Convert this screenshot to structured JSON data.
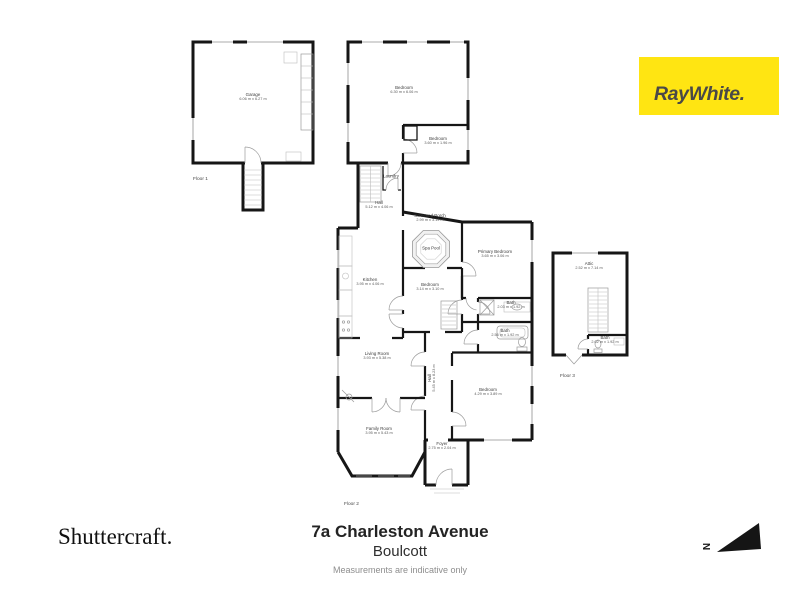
{
  "branding": {
    "logo_text": "RayWhite.",
    "logo_bg": "#FFE512",
    "logo_fg": "#4A4947"
  },
  "compass": {
    "label": "N"
  },
  "footer": {
    "photographer": "Shuttercraft.",
    "address_line1": "7a Charleston Avenue",
    "address_line2": "Boulcott",
    "disclaimer": "Measurements are indicative only"
  },
  "floors": [
    {
      "caption": "Floor 1",
      "caption_pos": {
        "x": 193,
        "y": 177
      },
      "rooms": [
        {
          "name": "Garage",
          "dims": "6.06 m x 6.27 m",
          "x": 253,
          "y": 97
        }
      ]
    },
    {
      "caption": "Floor 2",
      "caption_pos": {
        "x": 344,
        "y": 502
      },
      "rooms": [
        {
          "name": "Bedroom",
          "dims": "6.30 m x 6.06 m",
          "x": 404,
          "y": 90
        },
        {
          "name": "Bedroom",
          "dims": "3.60 m x 1.96 m",
          "x": 438,
          "y": 141
        },
        {
          "name": "Laundry",
          "dims": "",
          "x": 391,
          "y": 176
        },
        {
          "name": "Hall",
          "dims": "5.12 m x 4.06 m",
          "x": 379,
          "y": 205
        },
        {
          "name": "Screened Porch",
          "dims": "2.99 m x 3.19 m",
          "x": 430,
          "y": 218
        },
        {
          "name": "Spa Pool",
          "dims": "",
          "x": 431,
          "y": 248
        },
        {
          "name": "Primary Bedroom",
          "dims": "3.65 m x 3.06 m",
          "x": 495,
          "y": 254
        },
        {
          "name": "Kitchen",
          "dims": "3.95 m x 4.06 m",
          "x": 370,
          "y": 282
        },
        {
          "name": "Bedroom",
          "dims": "3.14 m x 3.10 m",
          "x": 430,
          "y": 287
        },
        {
          "name": "Bath",
          "dims": "2.03 m x 1.92 m",
          "x": 511,
          "y": 305
        },
        {
          "name": "Bath",
          "dims": "2.56 m x 1.92 m",
          "x": 505,
          "y": 333
        },
        {
          "name": "Living Room",
          "dims": "3.93 m x 5.38 m",
          "x": 377,
          "y": 356
        },
        {
          "name": "Hall",
          "dims": "5.45 m x 8.23 m",
          "x": 432,
          "y": 378,
          "rot": true
        },
        {
          "name": "Bedroom",
          "dims": "4.29 m x 3.89 m",
          "x": 488,
          "y": 392
        },
        {
          "name": "Family Room",
          "dims": "3.95 m x 5.43 m",
          "x": 379,
          "y": 431
        },
        {
          "name": "Foyer",
          "dims": "2.75 m x 2.04 m",
          "x": 442,
          "y": 446
        }
      ]
    },
    {
      "caption": "Floor 3",
      "caption_pos": {
        "x": 560,
        "y": 374
      },
      "rooms": [
        {
          "name": "Attic",
          "dims": "2.52 m x 7.14 m",
          "x": 589,
          "y": 266
        },
        {
          "name": "Bath",
          "dims": "2.02 m x 1.92 m",
          "x": 605,
          "y": 340
        }
      ]
    }
  ]
}
